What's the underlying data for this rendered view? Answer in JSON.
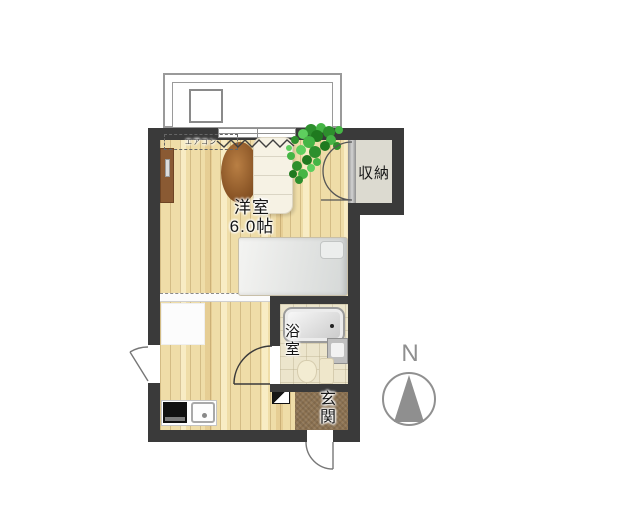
{
  "rooms": {
    "main": {
      "name": "洋室",
      "size": "6.0帖"
    },
    "storage": {
      "name": "収納"
    },
    "bathroom": {
      "name": "浴室"
    },
    "entrance": {
      "name": "玄関"
    }
  },
  "equipment": {
    "aircon_label": "エアコン"
  },
  "compass": {
    "north_label": "N"
  },
  "colors": {
    "wall": "#3a3a3a",
    "wood_floor": "#efdda8",
    "entrance_tile": "#8d7352",
    "storage_floor": "#dcdad0",
    "divider_gray": "#9a9a9a",
    "compass_gray": "#8f8f8f",
    "table_brown": "#8a5526",
    "plant_green": "#3aa53a",
    "curtain_line": "#3f3f3f"
  }
}
